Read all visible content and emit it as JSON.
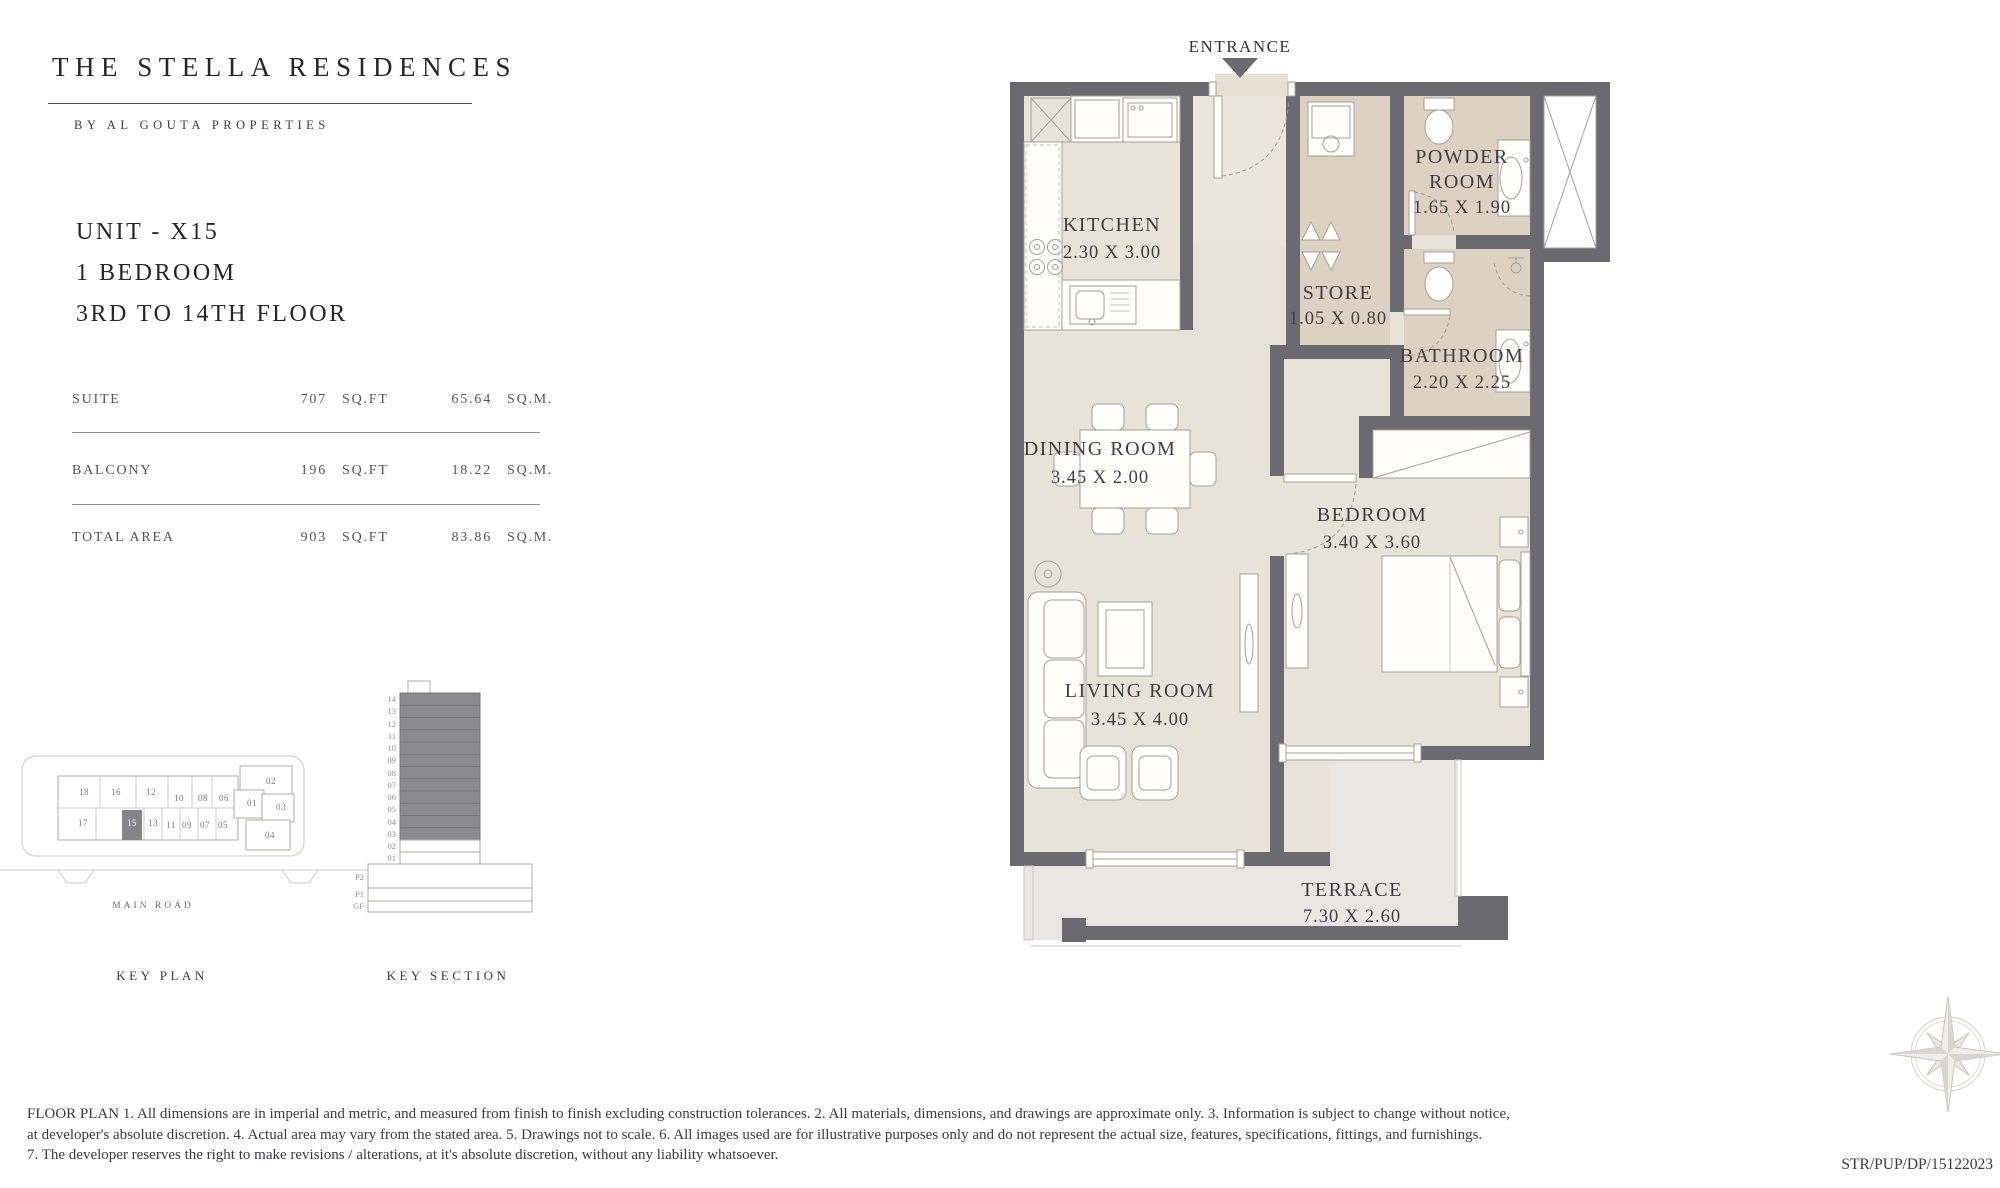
{
  "header": {
    "title": "THE STELLA RESIDENCES",
    "subtitle": "BY AL GOUTA PROPERTIES"
  },
  "unit": {
    "name": "UNIT - X15",
    "type": "1 BEDROOM",
    "floors": "3RD TO 14TH FLOOR"
  },
  "area_table": {
    "rows": [
      {
        "label": "SUITE",
        "imperial_value": "707",
        "imperial_unit": "SQ.FT",
        "metric_value": "65.64",
        "metric_unit": "SQ.M."
      },
      {
        "label": "BALCONY",
        "imperial_value": "196",
        "imperial_unit": "SQ.FT",
        "metric_value": "18.22",
        "metric_unit": "SQ.M."
      },
      {
        "label": "TOTAL AREA",
        "imperial_value": "903",
        "imperial_unit": "SQ.FT",
        "metric_value": "83.86",
        "metric_unit": "SQ.M."
      }
    ]
  },
  "floor_plan": {
    "entrance_label": "ENTRANCE",
    "rooms": {
      "kitchen": {
        "name": "KITCHEN",
        "dims": "2.30 X 3.00"
      },
      "powder_room": {
        "line1": "POWDER",
        "line2": "ROOM",
        "dims": "1.65 X 1.90"
      },
      "store": {
        "name": "STORE",
        "dims": "1.05 X 0.80"
      },
      "bathroom": {
        "name": "BATHROOM",
        "dims": "2.20 X 2.25"
      },
      "dining_room": {
        "name": "DINING ROOM",
        "dims": "3.45 X 2.00"
      },
      "bedroom": {
        "name": "BEDROOM",
        "dims": "3.40 X 3.60"
      },
      "living_room": {
        "name": "LIVING ROOM",
        "dims": "3.45 X 4.00"
      },
      "terrace": {
        "name": "TERRACE",
        "dims": "7.30 X 2.60"
      }
    }
  },
  "key_plan": {
    "caption": "KEY PLAN",
    "road_label": "MAIN ROAD",
    "unit_labels": [
      "18",
      "16",
      "12",
      "10",
      "08",
      "06",
      "02",
      "01",
      "03",
      "04",
      "17",
      "15",
      "13",
      "11",
      "09",
      "07",
      "05"
    ]
  },
  "key_section": {
    "caption": "KEY SECTION",
    "floor_labels": [
      "14",
      "13",
      "12",
      "11",
      "10",
      "09",
      "08",
      "07",
      "06",
      "05",
      "04",
      "03",
      "02",
      "01"
    ],
    "podium_labels": [
      "P2",
      "P1",
      "GF"
    ]
  },
  "footer": {
    "line1": "FLOOR PLAN 1. All dimensions are in imperial and metric, and measured from finish to finish excluding construction tolerances. 2. All materials, dimensions, and drawings are approximate only. 3. Information is subject to change without notice,",
    "line2": "at developer's absolute discretion. 4. Actual area may vary from the stated area. 5. Drawings not to scale. 6. All images used are for illustrative purposes only and do not represent the actual size, features, specifications, fittings, and furnishings.",
    "line3": "7. The developer reserves the right to make revisions / alterations, at it's absolute discretion, without any liability whatsoever.",
    "reference": "STR/PUP/DP/15122023"
  },
  "colors": {
    "wall": "#6b6a72",
    "floor": "#e9e2d6",
    "wet_floor": "#ddd2c2",
    "terrace": "#e8e7e2",
    "highlight": "#85848b",
    "text": "#3f3e47"
  }
}
